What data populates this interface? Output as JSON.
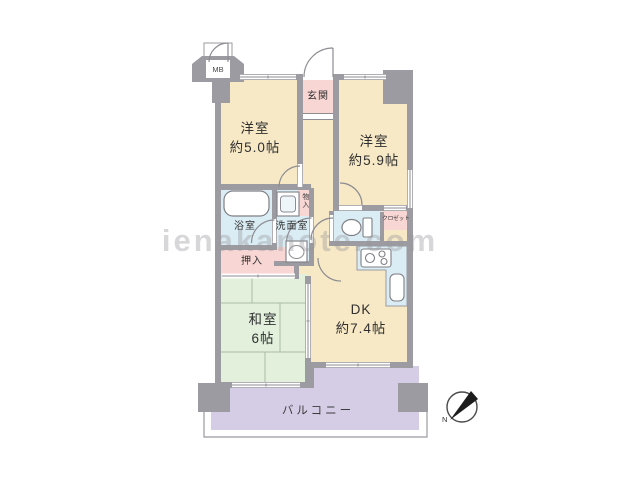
{
  "plan": {
    "type_note": "apartment floor plan",
    "watermark": "ienakanote.com",
    "rooms": {
      "western1": {
        "name": "洋室",
        "size": "約5.0帖"
      },
      "western2": {
        "name": "洋室",
        "size": "約5.9帖"
      },
      "japanese": {
        "name": "和室",
        "size": "6帖"
      },
      "dk": {
        "name": "DK",
        "size": "約7.4帖"
      },
      "entrance": {
        "name": "玄関"
      },
      "bathroom": {
        "name": "浴室"
      },
      "washroom": {
        "name": "洗面室"
      },
      "storage": {
        "name": "物入"
      },
      "closet": {
        "name": "クロゼット"
      },
      "oshiire": {
        "name": "押入"
      },
      "balcony": {
        "name": "バルコニー"
      },
      "meter_box": {
        "name": "MB"
      }
    },
    "compass": {
      "label": "N"
    },
    "colors": {
      "wall": "#9b9ba1",
      "room_cream": "#f7e8c6",
      "wet_blue": "#daedf4",
      "tatami_green": "#e2f0dc",
      "storage_pink": "#f8d6d4",
      "balcony_purple": "#d5cce6",
      "line_gray": "#8d8d92"
    }
  }
}
